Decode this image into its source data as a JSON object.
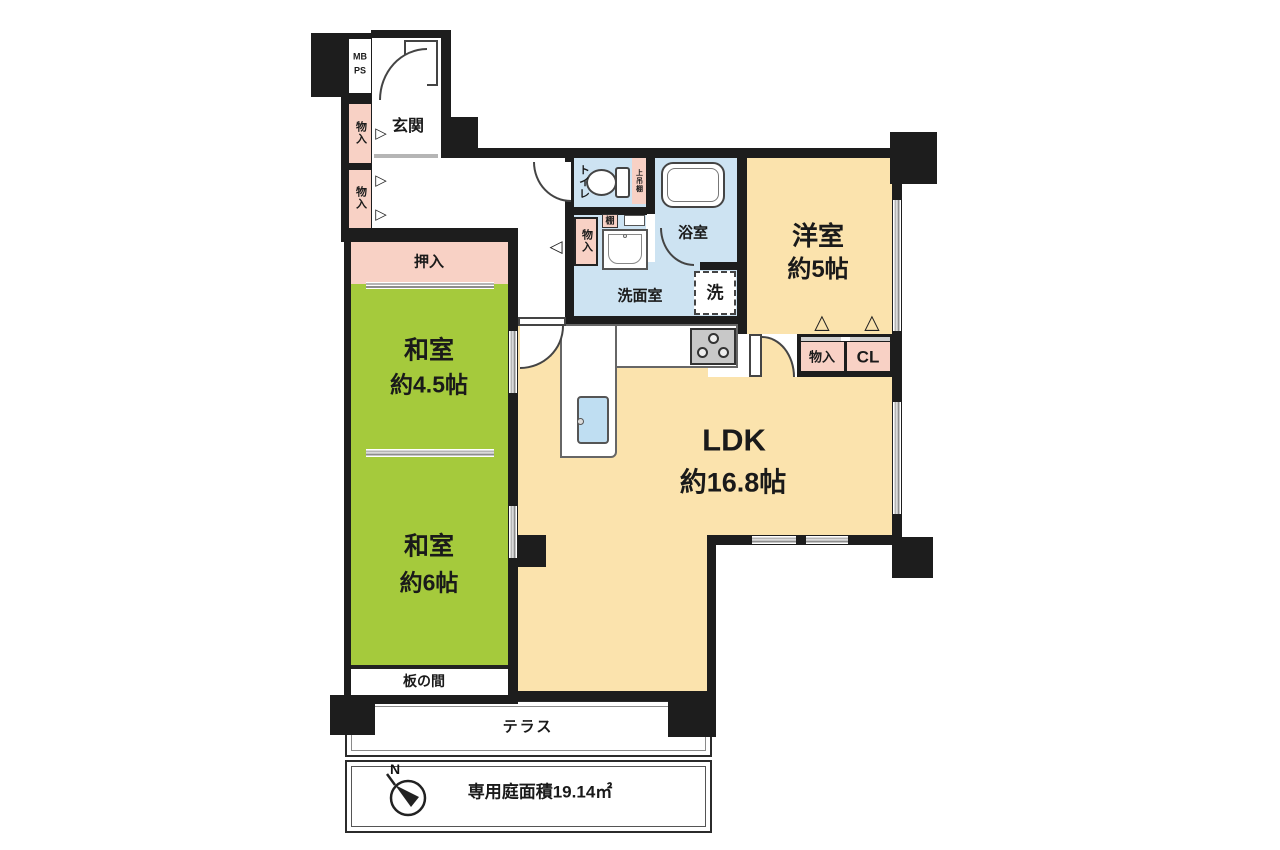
{
  "colors": {
    "wall": "#1d1d1d",
    "tatami_green": "#a5ca3c",
    "flooring_tan": "#fbe3ad",
    "storage_pink": "#f8d1c5",
    "wet_area_blue": "#cde3f2",
    "sink_blue": "#bfdef2",
    "door_mark_gray": "#9a9a9a"
  },
  "labels": {
    "mb": "MB",
    "ps": "PS",
    "genkan": "玄関",
    "monoiri_left_1": "物入",
    "monoiri_left_2": "物入",
    "oshiire": "押入",
    "washitsu45_name": "和室",
    "washitsu45_size": "約4.5帖",
    "washitsu6_name": "和室",
    "washitsu6_size": "約6帖",
    "itanoma": "板の間",
    "terrace": "テラス",
    "garden_area": "専用庭面積19.14㎡",
    "compass_north": "N",
    "toilet": "トイレ",
    "upper_shelf": "上吊棚",
    "shelf": "棚",
    "hall_monoiri": "物入",
    "senmenshitsu": "洗面室",
    "washer": "洗",
    "bathroom": "浴室",
    "youshitsu_name": "洋室",
    "youshitsu_size": "約5帖",
    "closet_monoiri": "物入",
    "closet_cl": "CL",
    "ldk_name": "LDK",
    "ldk_size": "約16.8帖"
  }
}
